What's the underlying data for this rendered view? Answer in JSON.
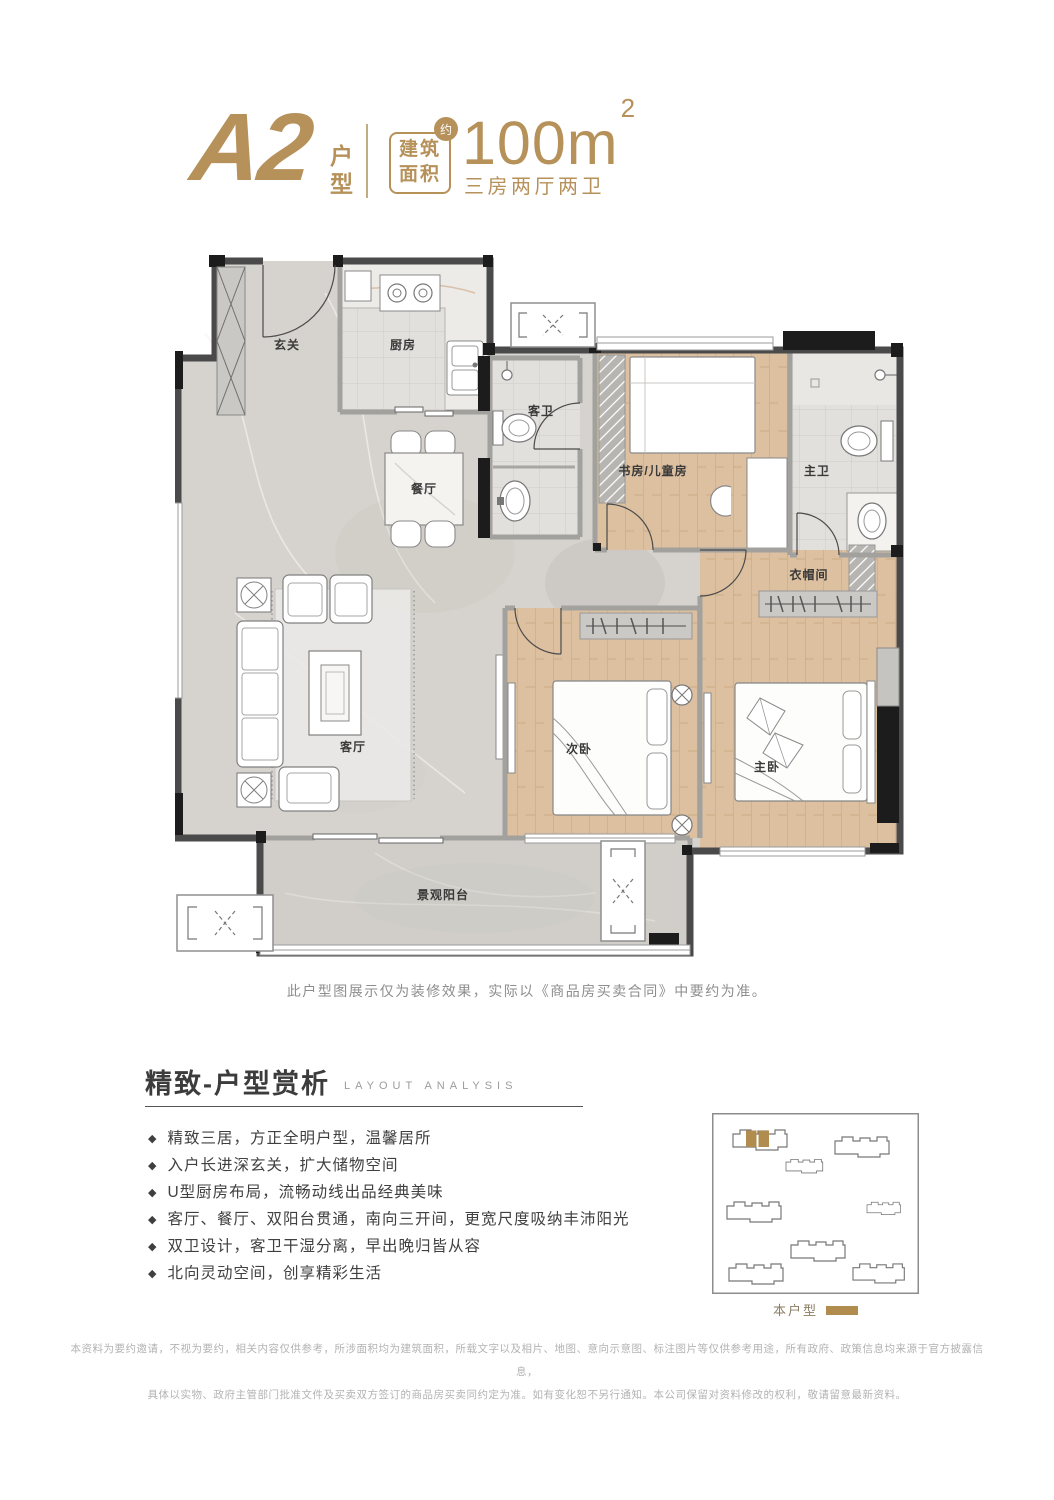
{
  "header": {
    "unit_code": "A2",
    "unit_suffix": "户型",
    "area_box": {
      "line1": "建筑",
      "line2": "面积",
      "approx": "约"
    },
    "area_value": "100m",
    "area_sup": "2",
    "layout_desc": "三房两厅两卫"
  },
  "plan": {
    "caption": "此户型图展示仅为装修效果，实际以《商品房买卖合同》中要约为准。",
    "rooms": [
      {
        "id": "entry",
        "label": "玄关"
      },
      {
        "id": "kitchen",
        "label": "厨房"
      },
      {
        "id": "guest-bath",
        "label": "客卫"
      },
      {
        "id": "study",
        "label": "书房/儿童房"
      },
      {
        "id": "master-bath",
        "label": "主卫"
      },
      {
        "id": "dining",
        "label": "餐厅"
      },
      {
        "id": "cloakroom",
        "label": "衣帽间"
      },
      {
        "id": "living",
        "label": "客厅"
      },
      {
        "id": "second-bedroom",
        "label": "次卧"
      },
      {
        "id": "master-bedroom",
        "label": "主卧"
      },
      {
        "id": "balcony",
        "label": "景观阳台"
      }
    ]
  },
  "analysis": {
    "title_cn": "精致-户型赏析",
    "title_en": "LAYOUT ANALYSIS",
    "bullet_glyph": "◆",
    "bullets": [
      "精致三居，方正全明户型，温馨居所",
      "入户长进深玄关，扩大储物空间",
      "U型厨房布局，流畅动线出品经典美味",
      "客厅、餐厅、双阳台贯通，南向三开间，更宽尺度吸纳丰沛阳光",
      "双卫设计，客卫干湿分离，早出晚归皆从容",
      "北向灵动空间，创享精彩生活"
    ]
  },
  "siteplan": {
    "legend_label": "本户型"
  },
  "footer": {
    "line1": "本资料为要约邀请，不视为要约，相关内容仅供参考，所涉面积均为建筑面积，所载文字以及相片、地图、意向示意图、标注图片等仅供参考用途，所有政府、政策信息均来源于官方披露信息，",
    "line2": "具体以实物、政府主管部门批准文件及买卖双方签订的商品房买卖同约定为准。如有变化恕不另行通知。本公司保留对资料修改的权利，敬请留意最新资料。"
  },
  "colors": {
    "gold": "#b6915a",
    "legend_gold": "#b08c4e"
  }
}
